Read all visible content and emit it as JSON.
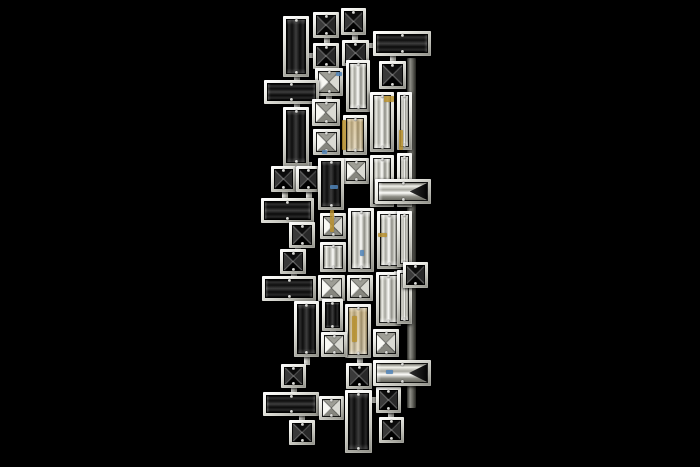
{
  "meta": {
    "subject": "Modern crystal wall sconce photographed on a black background",
    "background_color": "#000000"
  },
  "fixture": {
    "frame_color": "#ecece6",
    "dark_crystal_color": "#0a0a0a",
    "clear_crystal_color": "#d8d8d0",
    "amber_accent_color": "#b8912f",
    "blue_accent_color": "#4f83b8",
    "backplates": [
      {
        "x": 407,
        "y": 58,
        "w": 9,
        "h": 350
      }
    ],
    "pieces": [
      {
        "x": 313,
        "y": 12,
        "w": 26,
        "h": 26,
        "kind": "dark-x"
      },
      {
        "x": 341,
        "y": 8,
        "w": 25,
        "h": 27,
        "kind": "dark-x"
      },
      {
        "x": 283,
        "y": 16,
        "w": 26,
        "h": 61,
        "kind": "dark-v"
      },
      {
        "x": 313,
        "y": 43,
        "w": 26,
        "h": 26,
        "kind": "dark-x"
      },
      {
        "x": 342,
        "y": 40,
        "w": 27,
        "h": 26,
        "kind": "dark-x"
      },
      {
        "x": 373,
        "y": 31,
        "w": 58,
        "h": 25,
        "kind": "dark-h"
      },
      {
        "x": 315,
        "y": 68,
        "w": 28,
        "h": 28,
        "kind": "clear-x"
      },
      {
        "x": 346,
        "y": 60,
        "w": 24,
        "h": 52,
        "kind": "clear-v"
      },
      {
        "x": 379,
        "y": 61,
        "w": 27,
        "h": 28,
        "kind": "dark-x"
      },
      {
        "x": 264,
        "y": 80,
        "w": 55,
        "h": 24,
        "kind": "dark-h"
      },
      {
        "x": 283,
        "y": 107,
        "w": 26,
        "h": 59,
        "kind": "dark-v"
      },
      {
        "x": 312,
        "y": 99,
        "w": 28,
        "h": 27,
        "kind": "clear-x"
      },
      {
        "x": 313,
        "y": 129,
        "w": 27,
        "h": 26,
        "kind": "clear-x"
      },
      {
        "x": 343,
        "y": 115,
        "w": 24,
        "h": 40,
        "kind": "amber-v"
      },
      {
        "x": 370,
        "y": 92,
        "w": 24,
        "h": 60,
        "kind": "clear-v"
      },
      {
        "x": 397,
        "y": 92,
        "w": 15,
        "h": 58,
        "kind": "clear-v"
      },
      {
        "x": 343,
        "y": 158,
        "w": 26,
        "h": 26,
        "kind": "clear-x"
      },
      {
        "x": 370,
        "y": 155,
        "w": 24,
        "h": 52,
        "kind": "clear-v"
      },
      {
        "x": 397,
        "y": 153,
        "w": 15,
        "h": 54,
        "kind": "clear-v"
      },
      {
        "x": 271,
        "y": 166,
        "w": 25,
        "h": 26,
        "kind": "dark-x"
      },
      {
        "x": 296,
        "y": 166,
        "w": 24,
        "h": 26,
        "kind": "dark-x"
      },
      {
        "x": 261,
        "y": 198,
        "w": 53,
        "h": 25,
        "kind": "dark-h"
      },
      {
        "x": 318,
        "y": 158,
        "w": 26,
        "h": 52,
        "kind": "dark-v"
      },
      {
        "x": 289,
        "y": 222,
        "w": 26,
        "h": 26,
        "kind": "dark-x"
      },
      {
        "x": 280,
        "y": 249,
        "w": 26,
        "h": 25,
        "kind": "dark-x"
      },
      {
        "x": 262,
        "y": 276,
        "w": 54,
        "h": 25,
        "kind": "dark-h"
      },
      {
        "x": 320,
        "y": 213,
        "w": 26,
        "h": 26,
        "kind": "clear-x"
      },
      {
        "x": 348,
        "y": 208,
        "w": 26,
        "h": 64,
        "kind": "clear-v"
      },
      {
        "x": 377,
        "y": 211,
        "w": 24,
        "h": 58,
        "kind": "clear-v"
      },
      {
        "x": 397,
        "y": 211,
        "w": 15,
        "h": 56,
        "kind": "clear-v"
      },
      {
        "x": 320,
        "y": 242,
        "w": 26,
        "h": 30,
        "kind": "clear-v"
      },
      {
        "x": 318,
        "y": 275,
        "w": 27,
        "h": 26,
        "kind": "clear-x"
      },
      {
        "x": 347,
        "y": 275,
        "w": 26,
        "h": 26,
        "kind": "clear-x"
      },
      {
        "x": 376,
        "y": 272,
        "w": 25,
        "h": 54,
        "kind": "clear-v"
      },
      {
        "x": 397,
        "y": 270,
        "w": 15,
        "h": 54,
        "kind": "clear-v"
      },
      {
        "x": 345,
        "y": 304,
        "w": 26,
        "h": 54,
        "kind": "amber-v"
      },
      {
        "x": 294,
        "y": 301,
        "w": 25,
        "h": 56,
        "kind": "dark-v"
      },
      {
        "x": 322,
        "y": 299,
        "w": 21,
        "h": 32,
        "kind": "dark-v"
      },
      {
        "x": 321,
        "y": 332,
        "w": 26,
        "h": 25,
        "kind": "clear-x"
      },
      {
        "x": 373,
        "y": 329,
        "w": 26,
        "h": 28,
        "kind": "clear-x"
      },
      {
        "x": 375,
        "y": 179,
        "w": 56,
        "h": 25,
        "kind": "clear-h-de"
      },
      {
        "x": 403,
        "y": 262,
        "w": 25,
        "h": 26,
        "kind": "dark-x"
      },
      {
        "x": 281,
        "y": 364,
        "w": 25,
        "h": 24,
        "kind": "dark-x"
      },
      {
        "x": 263,
        "y": 392,
        "w": 56,
        "h": 24,
        "kind": "dark-h"
      },
      {
        "x": 319,
        "y": 396,
        "w": 25,
        "h": 24,
        "kind": "clear-x"
      },
      {
        "x": 289,
        "y": 420,
        "w": 26,
        "h": 25,
        "kind": "dark-x"
      },
      {
        "x": 346,
        "y": 363,
        "w": 26,
        "h": 26,
        "kind": "dark-x"
      },
      {
        "x": 345,
        "y": 390,
        "w": 27,
        "h": 63,
        "kind": "dark-v"
      },
      {
        "x": 376,
        "y": 387,
        "w": 25,
        "h": 26,
        "kind": "dark-x"
      },
      {
        "x": 379,
        "y": 417,
        "w": 25,
        "h": 26,
        "kind": "dark-x"
      },
      {
        "x": 373,
        "y": 360,
        "w": 58,
        "h": 26,
        "kind": "clear-h-de"
      }
    ],
    "connectors": [
      {
        "x": 324,
        "y": 37,
        "w": 6,
        "h": 7
      },
      {
        "x": 352,
        "y": 34,
        "w": 6,
        "h": 7
      },
      {
        "x": 308,
        "y": 53,
        "w": 6,
        "h": 5
      },
      {
        "x": 368,
        "y": 43,
        "w": 6,
        "h": 5
      },
      {
        "x": 326,
        "y": 94,
        "w": 6,
        "h": 6
      },
      {
        "x": 294,
        "y": 76,
        "w": 6,
        "h": 5
      },
      {
        "x": 294,
        "y": 103,
        "w": 6,
        "h": 5
      },
      {
        "x": 390,
        "y": 55,
        "w": 6,
        "h": 7
      },
      {
        "x": 283,
        "y": 162,
        "w": 6,
        "h": 5
      },
      {
        "x": 306,
        "y": 162,
        "w": 6,
        "h": 5
      },
      {
        "x": 282,
        "y": 190,
        "w": 6,
        "h": 9
      },
      {
        "x": 306,
        "y": 190,
        "w": 6,
        "h": 9
      },
      {
        "x": 300,
        "y": 220,
        "w": 6,
        "h": 4
      },
      {
        "x": 295,
        "y": 246,
        "w": 6,
        "h": 4
      },
      {
        "x": 291,
        "y": 272,
        "w": 6,
        "h": 5
      },
      {
        "x": 304,
        "y": 298,
        "w": 6,
        "h": 5
      },
      {
        "x": 304,
        "y": 355,
        "w": 6,
        "h": 10
      },
      {
        "x": 291,
        "y": 386,
        "w": 6,
        "h": 7
      },
      {
        "x": 299,
        "y": 414,
        "w": 6,
        "h": 7
      },
      {
        "x": 330,
        "y": 329,
        "w": 6,
        "h": 5
      },
      {
        "x": 357,
        "y": 352,
        "w": 6,
        "h": 12
      },
      {
        "x": 357,
        "y": 387,
        "w": 6,
        "h": 4
      },
      {
        "x": 370,
        "y": 397,
        "w": 7,
        "h": 6
      },
      {
        "x": 388,
        "y": 411,
        "w": 6,
        "h": 7
      },
      {
        "x": 394,
        "y": 271,
        "w": 10,
        "h": 5
      },
      {
        "x": 316,
        "y": 402,
        "w": 5,
        "h": 6
      }
    ],
    "accents": [
      {
        "x": 342,
        "y": 120,
        "w": 4,
        "h": 30,
        "color": "#b8912f"
      },
      {
        "x": 330,
        "y": 210,
        "w": 4,
        "h": 22,
        "color": "#b8912f"
      },
      {
        "x": 352,
        "y": 316,
        "w": 5,
        "h": 26,
        "color": "#b8912f"
      },
      {
        "x": 384,
        "y": 96,
        "w": 10,
        "h": 6,
        "color": "#b8912f"
      },
      {
        "x": 399,
        "y": 130,
        "w": 4,
        "h": 20,
        "color": "#b8912f"
      },
      {
        "x": 378,
        "y": 233,
        "w": 9,
        "h": 4,
        "color": "#b8912f"
      },
      {
        "x": 336,
        "y": 72,
        "w": 6,
        "h": 4,
        "color": "#4f83b8"
      },
      {
        "x": 322,
        "y": 150,
        "w": 5,
        "h": 4,
        "color": "#4f83b8"
      },
      {
        "x": 360,
        "y": 250,
        "w": 4,
        "h": 6,
        "color": "#4f83b8"
      },
      {
        "x": 386,
        "y": 370,
        "w": 7,
        "h": 4,
        "color": "#4f83b8"
      },
      {
        "x": 330,
        "y": 185,
        "w": 8,
        "h": 4,
        "color": "#4f83b8"
      }
    ]
  }
}
